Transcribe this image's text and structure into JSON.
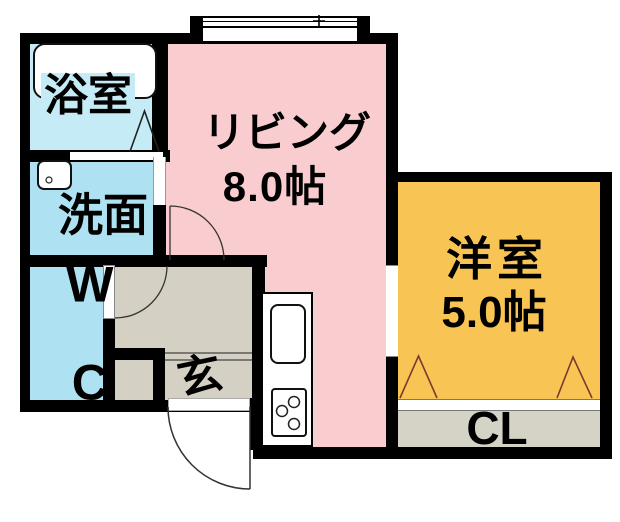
{
  "floorplan": {
    "type": "apartment-floor-plan",
    "rooms": {
      "bath": {
        "name": "浴室"
      },
      "washroom": {
        "name": "洗面"
      },
      "toilet": {
        "line1": "W",
        "line2": "C"
      },
      "living": {
        "name": "リビング",
        "size": "8.0帖"
      },
      "western_room": {
        "name": "洋室",
        "size": "5.0帖"
      },
      "closet": {
        "name": "CL"
      },
      "entrance": {
        "name": "玄"
      }
    },
    "colors": {
      "living_floor": "#F9CDCF",
      "bath_floor": "#C5ECF6",
      "water_floor": "#AEE2F2",
      "western_floor": "#F8C453",
      "entrance_floor": "#D4D0C3",
      "closet_floor": "#D5D2C6",
      "wall": "#000000",
      "closet_door_line": "#7A3B2E",
      "door_swing_line": "#333333",
      "fixture_line": "#222222"
    },
    "icons": {
      "bathtub": "bathtub-outline",
      "washbasin": "washbasin-outline",
      "kitchen_sink": "kitchen-sink-outline",
      "stove": "three-burner-stove",
      "bath_door": "folding-door-triangle",
      "closet_doors": "folding-door-triangles",
      "hinged_doors": "quarter-circle-door-swing",
      "window": "sliding-window-band"
    }
  }
}
